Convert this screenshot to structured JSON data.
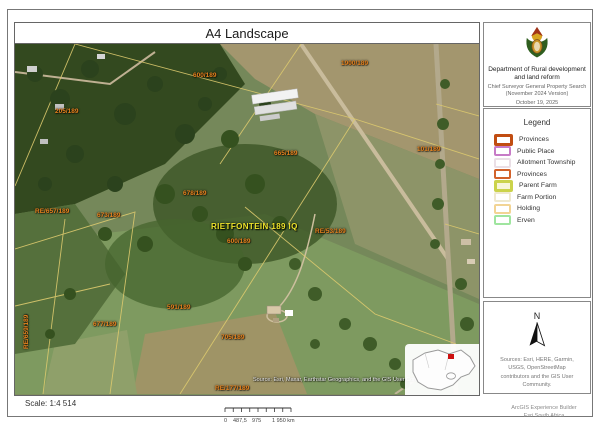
{
  "title": "A4 Landscape",
  "logo_panel": {
    "department_line1": "Department of Rural development",
    "department_line2": "and land reform",
    "subtitle_line1": "Chief Surveyor General Property Search",
    "subtitle_line2": "(November 2024 Version)",
    "date": "October 19, 2025"
  },
  "legend": {
    "title": "Legend",
    "items": [
      {
        "label": "Provinces",
        "color": "#c14d12",
        "border": 3,
        "fill": "#ffffff"
      },
      {
        "label": "Public Place",
        "color": "#c77bc7",
        "border": 2,
        "fill": "#ffffff"
      },
      {
        "label": "Allotment Township",
        "color": "#eadfe6",
        "border": 2,
        "fill": "#ffffff"
      },
      {
        "label": "Provinces",
        "color": "#d2622b",
        "border": 2,
        "fill": "#ffffff"
      },
      {
        "label": "Parent Farm",
        "color": "#cbd34b",
        "border": 3,
        "fill": "#f8f6d8"
      },
      {
        "label": "Farm Portion",
        "color": "#efe9cf",
        "border": 2,
        "fill": "#ffffff"
      },
      {
        "label": "Holding",
        "color": "#f2d494",
        "border": 2,
        "fill": "#ffffff"
      },
      {
        "label": "Erven",
        "color": "#9fe59f",
        "border": 2,
        "fill": "#ffffff"
      }
    ]
  },
  "north_panel": {
    "north_label": "N",
    "sources_text": "Sources: Esri, HERE, Garmin, USGS, OpenStreetMap contributors and the GIS User Community."
  },
  "map": {
    "attribution": "Source: Esri, Maxar, Earthstar Geographics, and the GIS User Community",
    "labels": [
      {
        "text": "205/189"
      },
      {
        "text": "600/189"
      },
      {
        "text": "1900/189"
      },
      {
        "text": "665/189"
      },
      {
        "text": "101/189"
      },
      {
        "text": "RE/657/189"
      },
      {
        "text": "673/189"
      },
      {
        "text": "678/189"
      },
      {
        "text": "RIETFONTEIN 189 IQ"
      },
      {
        "text": "600/189"
      },
      {
        "text": "RE/53/189"
      },
      {
        "text": "591/189"
      },
      {
        "text": "677/189"
      },
      {
        "text": "705/189"
      },
      {
        "text": "129/189"
      },
      {
        "text": "RE/177/189"
      },
      {
        "text": "RE/659/189"
      }
    ]
  },
  "scale": {
    "text": "Scale: 1:4 514",
    "tick_labels": [
      "0",
      "487,5",
      "975",
      "1 950 km"
    ]
  },
  "credit": {
    "line1": "ArcGIS Experience Builder",
    "line2": "Esri South Africa"
  }
}
